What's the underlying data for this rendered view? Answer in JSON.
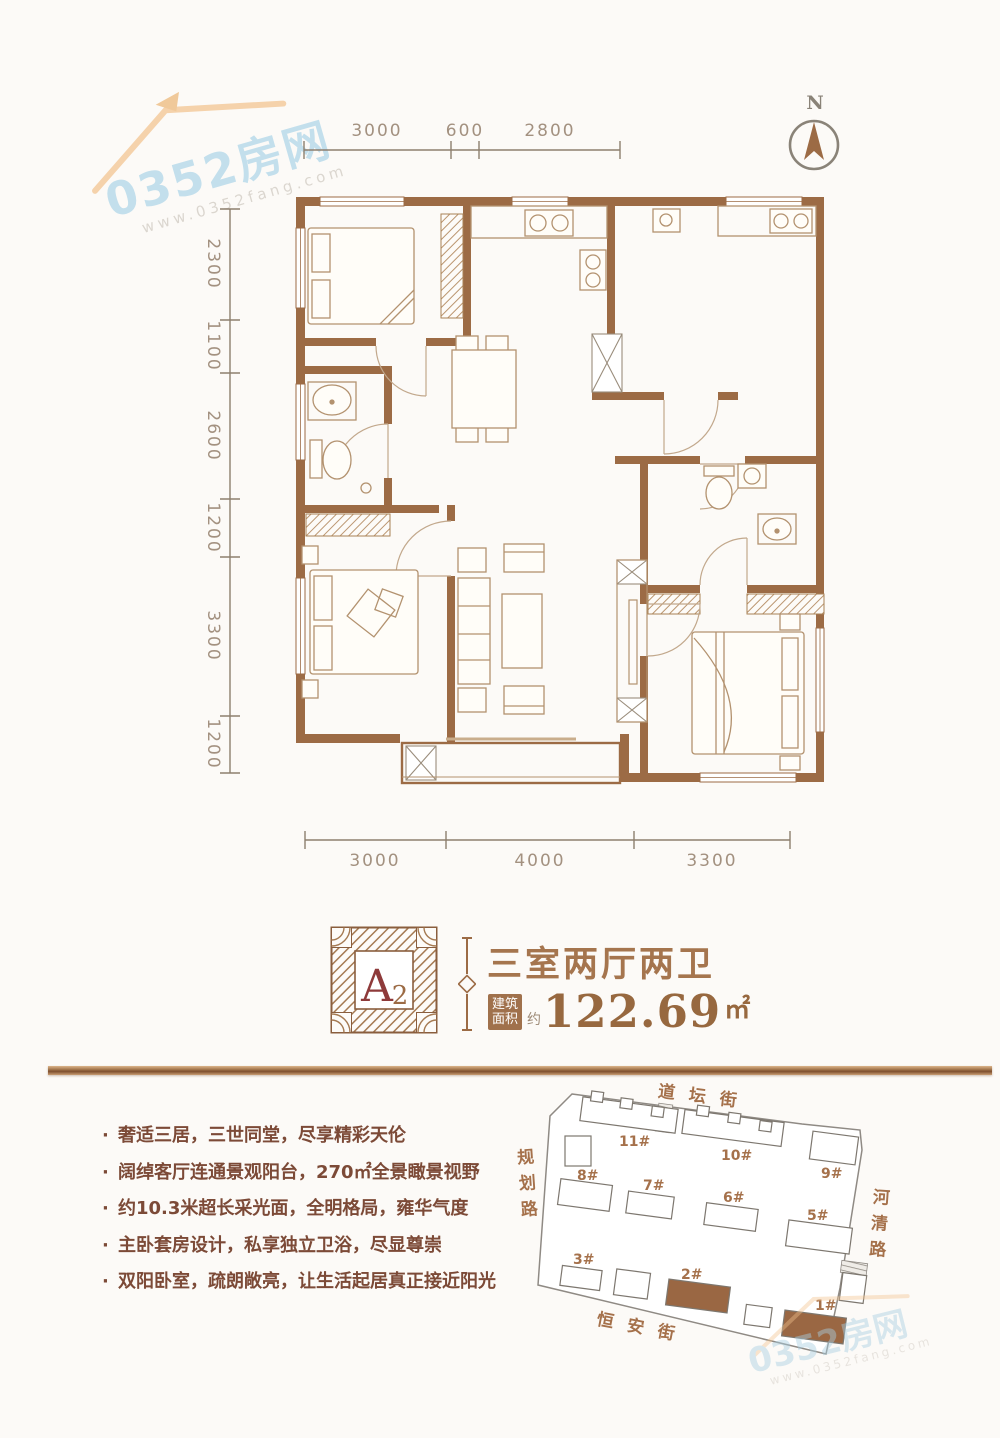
{
  "watermark": {
    "brand": "0352房网",
    "url": "www.0352fang.com"
  },
  "compass": {
    "label": "N"
  },
  "dimensions": {
    "top": [
      "3000",
      "600",
      "2800"
    ],
    "left": [
      "2300",
      "1100",
      "2600",
      "1200",
      "3300",
      "1200"
    ],
    "bottom": [
      "3000",
      "4000",
      "3300"
    ]
  },
  "unit_card": {
    "badge_letter": "A",
    "badge_number": "2",
    "title": "三室两厅两卫",
    "area_label_1": "建筑",
    "area_label_2": "面积",
    "area_approx": "约",
    "area_value": "122.69",
    "area_unit": "㎡"
  },
  "selling_points": [
    "奢适三居，三世同堂，尽享精彩天伦",
    "阔绰客厅连通景观阳台，270㎡全景瞰景视野",
    "约10.3米超长采光面，全明格局，雍华气度",
    "主卧套房设计，私享独立卫浴，尽显尊崇",
    "双阳卧室，疏朗敞亮，让生活起居真正接近阳光"
  ],
  "site_plan": {
    "streets": {
      "top": "道坛街",
      "left": "规划路",
      "right": "河清路",
      "bottom": "恒安街"
    },
    "buildings": [
      "11#",
      "10#",
      "9#",
      "8#",
      "7#",
      "6#",
      "5#",
      "3#",
      "2#",
      "1#"
    ],
    "highlighted": [
      "2#",
      "1#"
    ]
  },
  "colors": {
    "wall": "#9c6b45",
    "accent": "#a5754e",
    "deep_red": "#8e3a3a",
    "body_text": "#7c4a37",
    "dimension": "#a39180",
    "copper_bar": "#7e4f2e",
    "watermark_blue": "#b5d9ea",
    "watermark_orange": "#f2c28d"
  }
}
